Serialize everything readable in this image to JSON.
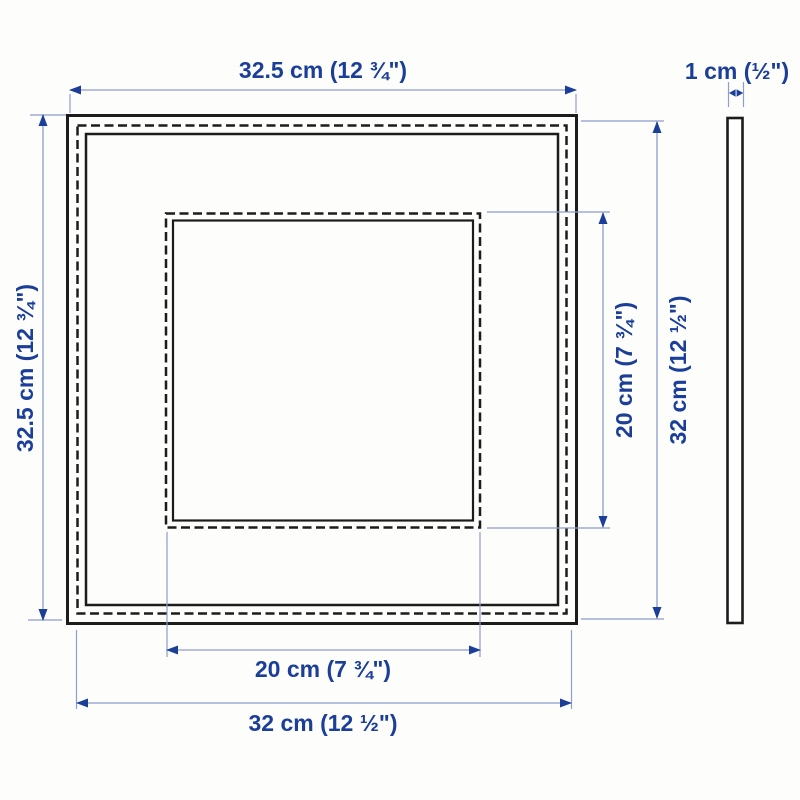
{
  "diagram": {
    "type": "product-dimension-drawing",
    "views": {
      "front": "square picture frame with dashed rabbet outlines and inner opening",
      "side": "thin edge profile strip"
    }
  },
  "colors": {
    "accent": "#1b3e99",
    "dim_line": "#8e9cce",
    "ink": "#1c1c1c",
    "background": "#fdfdfc"
  },
  "dimensions": {
    "top_width": "32.5 cm (12 ¾\")",
    "thickness": "1 cm (½\")",
    "left_height": "32.5 cm (12 ¾\")",
    "opening_height": "20 cm (7 ¾\")",
    "right_height": "32 cm (12 ½\")",
    "opening_width": "20 cm (7 ¾\")",
    "bottom_width": "32 cm (12 ½\")"
  }
}
